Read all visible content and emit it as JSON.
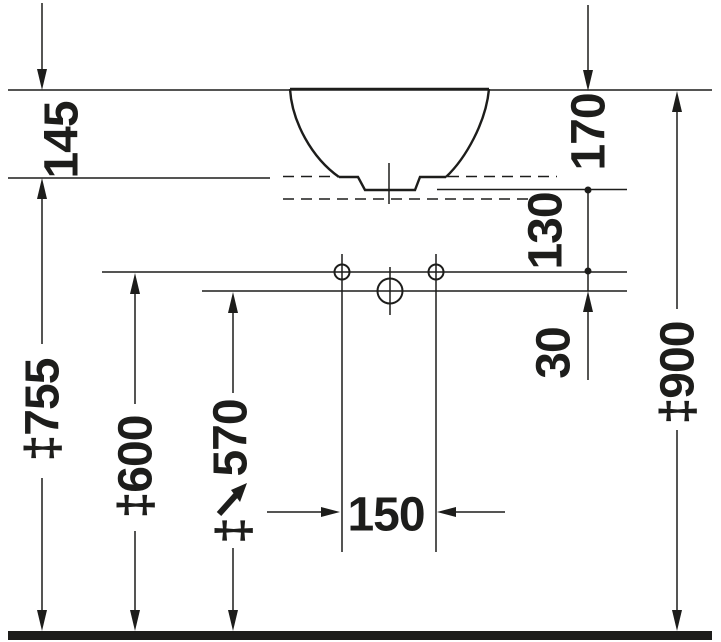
{
  "diagram": {
    "type": "technical dimension drawing",
    "subject": "countertop washbasin side elevation with installation dimensions",
    "units": "mm",
    "colors": {
      "line": "#1d1d1b",
      "background": "#ffffff",
      "floor": "#1d1d1b"
    },
    "labels": {
      "d145": "145",
      "d170": "170",
      "d130": "130",
      "d30": "30",
      "d755": "‡755",
      "d600": "‡600",
      "d570_value": "570",
      "d570_prefix": "‡",
      "d900": "‡900",
      "d150": "150"
    }
  }
}
